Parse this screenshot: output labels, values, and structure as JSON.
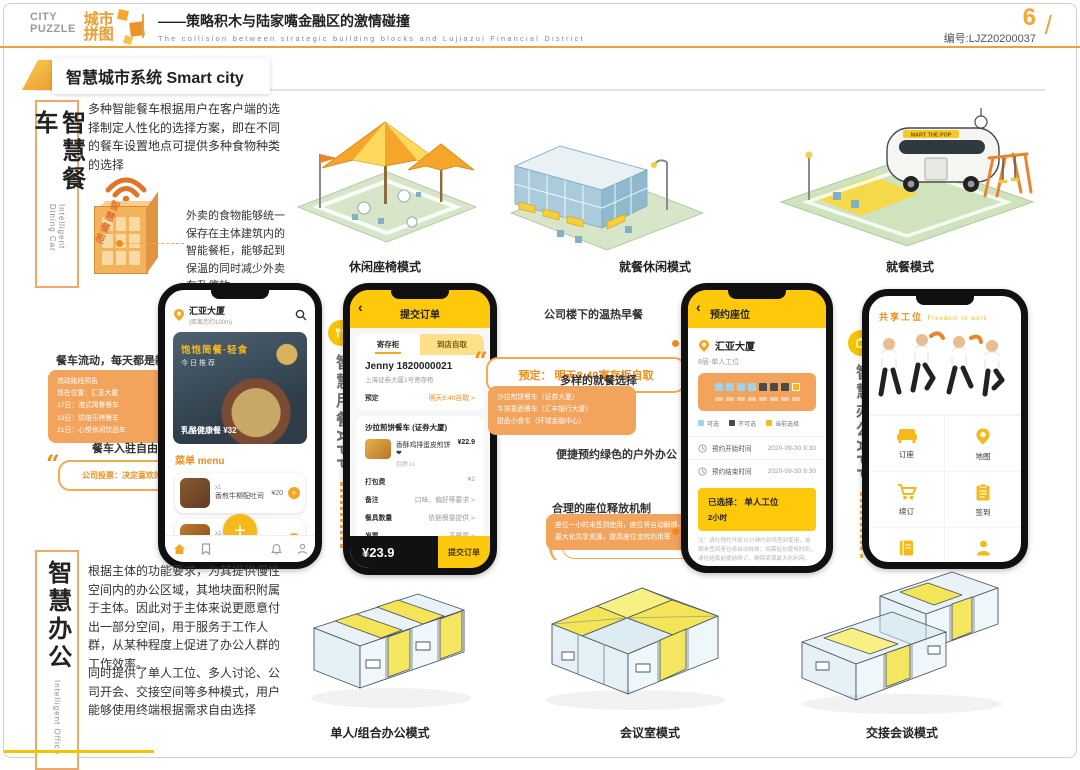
{
  "header": {
    "logo_en_line1": "CITY",
    "logo_en_line2": "PUZZLE",
    "logo_cn_line1": "城市",
    "logo_cn_line2": "拼图",
    "title_cn": "——策略积木与陆家嘴金融区的激情碰撞",
    "title_en": "The collision between strategic building blocks and Lujiazui Financial District",
    "page_number": "6",
    "serial": "编号:LJZ20200037",
    "slash": "/"
  },
  "section_title": "智慧城市系统 Smart city",
  "dining": {
    "label_cn": "智慧餐车",
    "label_en": "Intelligent Dining Car",
    "para1": "多种智能餐车根据用户在客户端的选择制定人性化的选择方案，即在不同的餐车设置地点可提供多种食物种类的选择",
    "cabinet_label": "智慧餐柜",
    "para2": "外卖的食物能够统一保存在主体建筑内的智能餐柜，能够起到保温的同时减少外卖车乱停放",
    "modes": [
      "休闲座椅模式",
      "就餐休闲模式",
      "就餐模式"
    ]
  },
  "notes_left": {
    "note1": "餐车流动，每天都是新口味",
    "route_lines": [
      "流动路线预告",
      "现在位置：汇亚大厦",
      "17日：港式简餐餐车",
      "19日：烘焙乐烤餐车",
      "21日：心悦休闲饮品车"
    ],
    "note2": "餐车入驻自由选",
    "quote": "公司投票：决定喜欢的餐车入驻"
  },
  "app_labels": {
    "dining": "智慧用餐APP",
    "office": "智慧办公APP"
  },
  "phone1": {
    "location": "汇亚大厦",
    "location_sub": "(距离您约100m)",
    "banner_title": "饱饱简餐·轻食",
    "banner_sub": "今日推荐",
    "banner_item": "乳酪健康餐 ¥32",
    "menu_header": "菜单 menu",
    "items": [
      {
        "qty": "x1",
        "name": "香煎牛柳配吐司",
        "price": "¥20"
      },
      {
        "qty": "x1",
        "name": "双层厚牛堡",
        "price": "¥28"
      },
      {
        "qty": "x1",
        "name": "",
        "price": ""
      }
    ]
  },
  "phone2": {
    "header": "提交订单",
    "tab_left": "寄存柜",
    "tab_right": "到店自取",
    "customer": "Jenny 1820000021",
    "address": "上海证券大厦1号寄存柜",
    "reserve_label": "预定",
    "reserve_value": "明天8:40自取 >",
    "shop": "沙拉煎饼餐车 (证券大厦)",
    "item_name": "香酥鸡排蛋皮煎饼❤",
    "item_tag": "招牌",
    "item_qty": "x1",
    "item_price": "¥22.9",
    "rows": [
      {
        "label": "打包费",
        "value": "¥2"
      },
      {
        "label": "备注",
        "value": "口味、偏好等要求 >"
      },
      {
        "label": "餐具数量",
        "value": "依据餐量提供 >"
      },
      {
        "label": "发票",
        "value": "不需要 >"
      },
      {
        "label": "支付方式",
        "value": "在线支付"
      },
      {
        "label": "门店新客立减",
        "value": "-¥1"
      }
    ],
    "total": "¥23.9",
    "submit": "提交订单"
  },
  "notes_mid": {
    "note1": "公司楼下的温热早餐",
    "quote1": "预定： 明天8:40寄存柜自取",
    "note2": "多样的就餐选择",
    "box2_lines": [
      "沙拉煎饼餐车（证券大厦）",
      "牛排意面餐车（汇丰银行大厦）",
      "甜品小食车（环球金融中心）"
    ],
    "note3": "便捷预约绿色的户外办公",
    "quote2": "可提前7天预订，单人/多人可供选择",
    "note4": "合理的座位释放机制",
    "box4_lines": [
      "座位一小时未签到使用，座位将自动解绑——",
      "最大化共享资源，提高座位流转利用率"
    ]
  },
  "phone3": {
    "header": "预约座位",
    "location": "汇亚大厦",
    "zone": "8层-单人工位",
    "legend": [
      "可选",
      "不可选",
      "当前选择"
    ],
    "row1_label": "预约开始时间",
    "row1_value": "2020-09-30 9:30",
    "row2_label": "预约结束时间",
    "row2_value": "2020-09-30 9:30",
    "selected_title": "已选择： 单人工位",
    "selected_sub": "2小时",
    "fine_print": "注：请在预约开始15分钟内到场签到使用，逾期未签到座位将自动释放；如需延长使用时间，请在结束前提前续订，确保资源最大化利用。",
    "agree_text": "已阅读并同意",
    "agree_link": "《工位预约使用须知》",
    "button": "立即预约"
  },
  "phone4": {
    "banner_title": "共享工位",
    "banner_en": "Freedom to work",
    "grid": [
      {
        "label": "订座"
      },
      {
        "label": "地图"
      },
      {
        "label": "续订"
      },
      {
        "label": "签到"
      },
      {
        "label": "预定记录"
      },
      {
        "label": "我的"
      }
    ]
  },
  "office": {
    "label_cn": "智慧办公",
    "label_en": "Intelligent Office",
    "para1": "根据主体的功能要求，为其提供慢性空间内的办公区域，其地块面积附属于主体。因此对于主体来说更愿意付出一部分空间，用于服务于工作人群，从某种程度上促进了办公人群的工作效率。",
    "para2": "同时提供了单人工位、多人讨论、公司开会、交接空间等多种模式，用户能够使用终端根据需求自由选择",
    "modes": [
      "单人/组合办公模式",
      "会议室模式",
      "交接会谈模式"
    ]
  },
  "truck_sign": "MART THE POP",
  "colors": {
    "accent": "#E9A23B",
    "app_yellow": "#FFC90B",
    "note_orange": "#F2A35C"
  },
  "icons": {
    "back": "‹",
    "plus": "+",
    "add": "+"
  }
}
